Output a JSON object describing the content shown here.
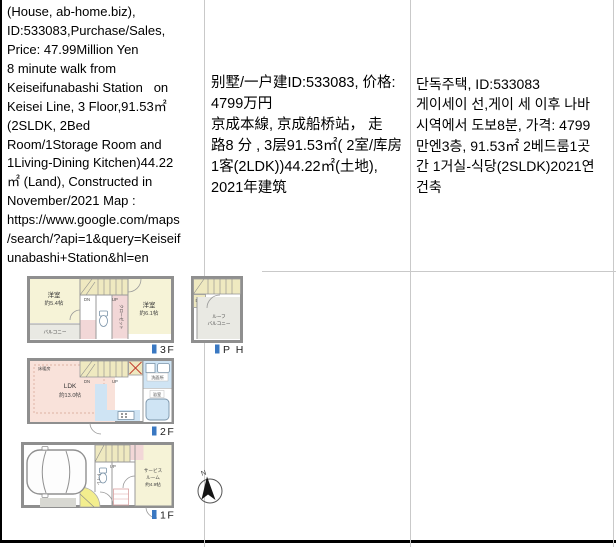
{
  "table": {
    "cells": {
      "en": {
        "lines": [
          "(House, ab-home.biz),",
          "ID:533083,Purchase/Sales,",
          "Price: 47.99Million Yen",
          "8 minute walk from",
          "Keiseifunabashi Station   on",
          "Keisei Line, 3 Floor,91.53㎡",
          "(2SLDK, 2Bed",
          "Room/1Storage Room and",
          "1Living-Dining Kitchen)44.22",
          "㎡ (Land), Constructed in",
          "November/2021 Map :",
          "https://www.google.com/maps",
          "/search/?api=1&query=Keiseif",
          "unabashi+Station&hl=en"
        ]
      },
      "zh": {
        "lines": [
          "别墅/一户建ID:533083, 价格:",
          "4799万円",
          "京成本線, 京成船桥站， 走",
          "路8 分 , 3层91.53㎡( 2室/库房",
          "1客(2LDK))44.22㎡(土地),",
          "2021年建筑"
        ]
      },
      "ko": {
        "lines": [
          "단독주택, ID:533083",
          "게이세이 선,게이 세 이후 나바",
          "시역에서 도보8분, 가격: 4799",
          "만엔3층, 91.53㎡ 2베드룸1곳",
          "간 1거실-식당(2SLDK)2021연",
          "건축"
        ]
      }
    }
  },
  "floorplan": {
    "floors": {
      "f3": "3F",
      "ph": "P H",
      "f2": "2F",
      "f1": "1F"
    },
    "labels": {
      "bedroom": "洋室",
      "size_54": "約5.4帖",
      "size_61": "約6.1帖",
      "balcony": "バルコニー",
      "roof_line1": "ルーフ",
      "roof_line2": "バルコニー",
      "dn": "DN",
      "up": "UP",
      "toilet": "トイレ",
      "closet": "クローゼット",
      "floor_heating": "床暖房",
      "ldk_line1": "LDK",
      "ldk_line2": "約13.0帖",
      "washroom": "洗面所",
      "bath": "浴室",
      "service_line1": "サービス",
      "service_line2": "ルーム",
      "service_line3": "約4.9帖",
      "north": "N"
    },
    "marker_color": "#3a78c2"
  }
}
